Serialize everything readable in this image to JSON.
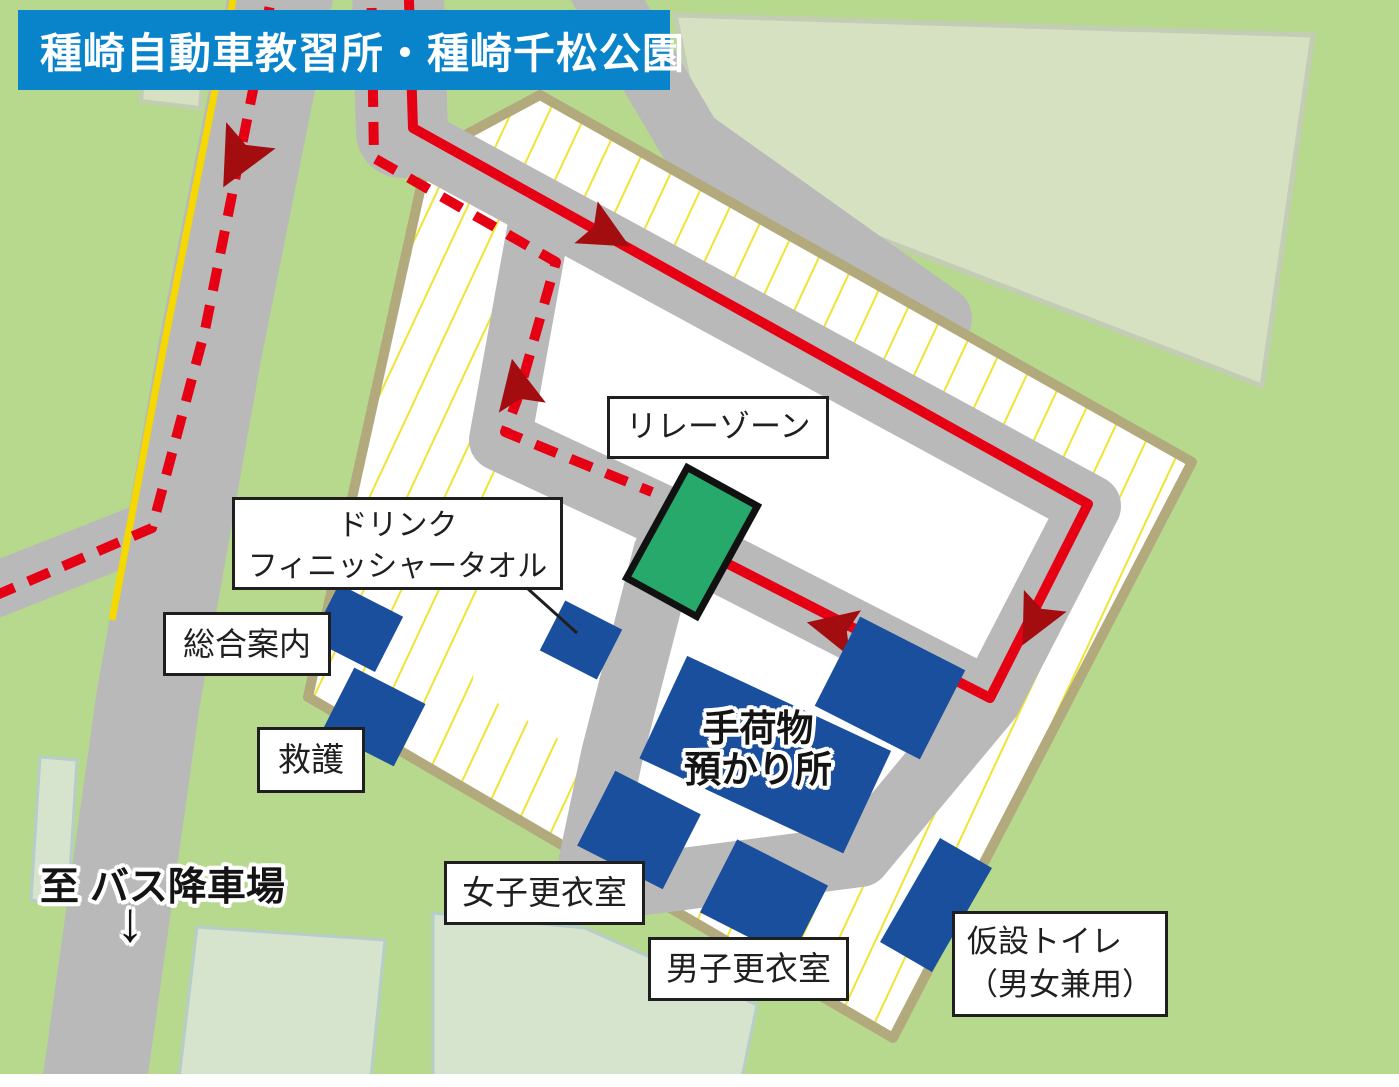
{
  "title": {
    "text": "種崎自動車教習所・種崎千松公園"
  },
  "map_labels": {
    "relay_zone": "リレーゾーン",
    "drink_line1": "ドリンク",
    "drink_line2": "フィニッシャータオル",
    "information": "総合案内",
    "first_aid": "救護",
    "baggage_line1": "手荷物",
    "baggage_line2": "預かり所",
    "womens_changing_room": "女子更衣室",
    "mens_changing_room": "男子更衣室",
    "temporary_toilet_line1": "仮設トイレ",
    "temporary_toilet_line2": "（男女兼用）",
    "to_bus_stop": "至 バス降車場",
    "bus_arrow": "↓"
  },
  "colors": {
    "title_background": "#0984cb",
    "title_text": "#ffffff",
    "background_green": "#b7d98e",
    "field_pale_green": "#d6e4cd",
    "field_border": "#b7cdc9",
    "large_lot_pale": "#d5e1c1",
    "road_gray": "#b9b9b9",
    "center_line_yellow": "#f5d800",
    "compound_border_tan": "#b2aa7d",
    "hatch_yellow": "#f0e433",
    "course_white": "#ffffff",
    "route_red": "#e60013",
    "arrow_dark_red": "#a30d10",
    "facility_blue": "#1a4f9e",
    "relay_zone_green": "#26a96b",
    "label_border_black": "#1f1f1f"
  }
}
